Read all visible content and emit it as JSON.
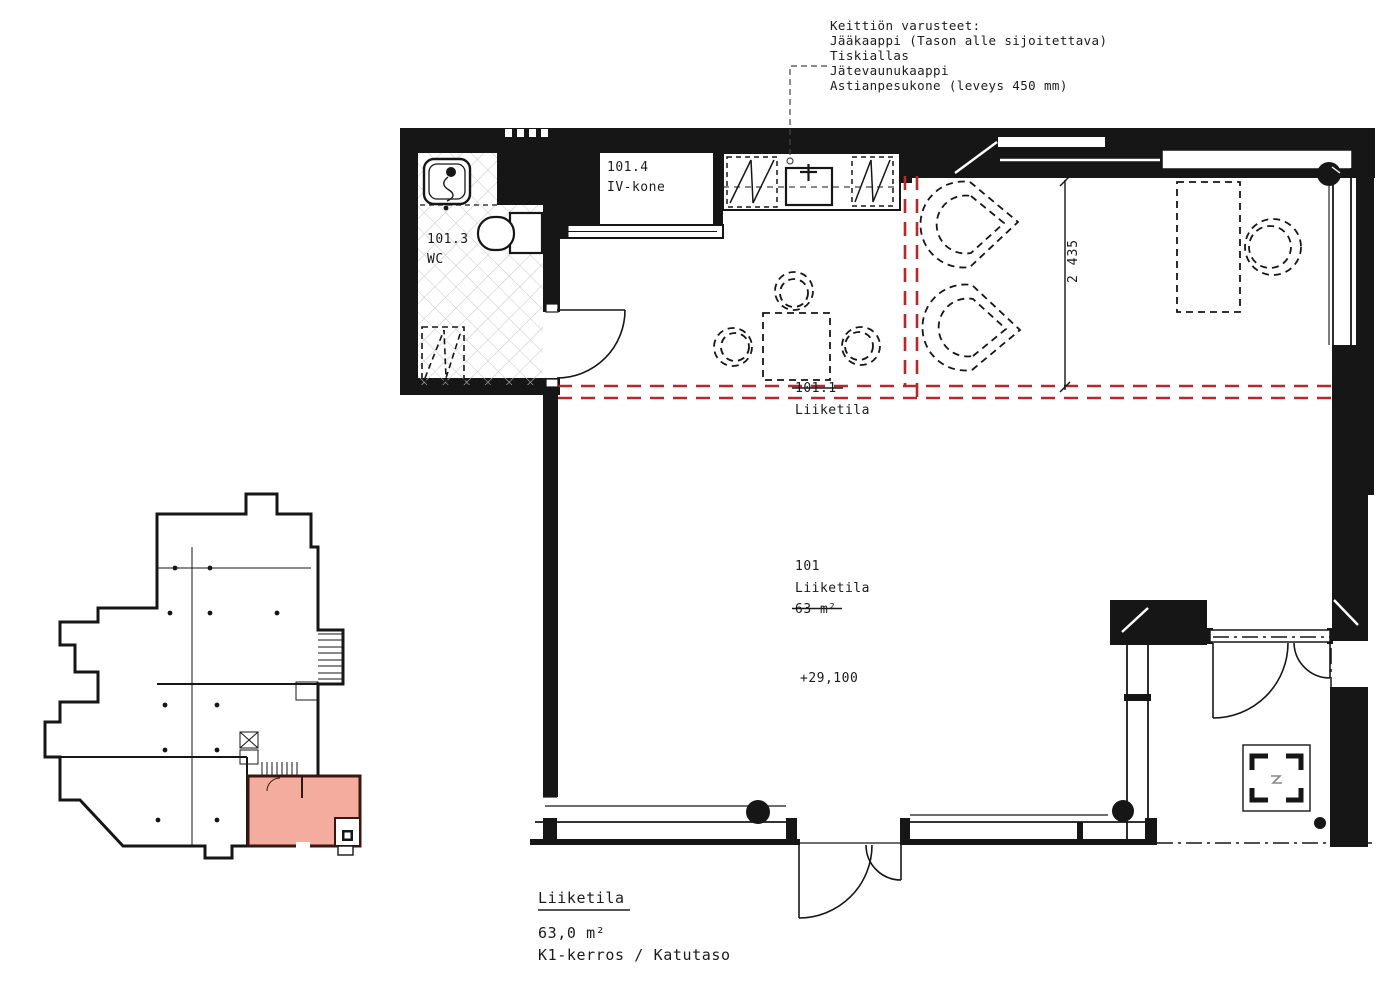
{
  "drawing": {
    "type": "floor-plan",
    "kitchen_note": {
      "lines": [
        "Keittiön varusteet:",
        "Jääkaappi (Tason alle sijoitettava)",
        "Tiskiallas",
        "Jätevaunukaappi",
        "Astianpesukone (leveys 450 mm)"
      ]
    },
    "rooms": {
      "iv_kone": {
        "number": "101.4",
        "name": "IV-kone"
      },
      "wc": {
        "number": "101.3",
        "name": "WC"
      },
      "liiketila_sub": {
        "number": "101.1",
        "name": "Liiketila",
        "number_strikethrough": true
      },
      "liiketila_main": {
        "number": "101",
        "name": "Liiketila",
        "area": "63 m²",
        "area_strikethrough": true,
        "level": "+29,100"
      }
    },
    "dimension": {
      "value": "2 435"
    },
    "footer": {
      "title": "Liiketila",
      "area": "63,0 m²",
      "floor": "K1-kerros / Katutaso"
    },
    "colors": {
      "line": "#161616",
      "red_boundary": "#b5282c",
      "unit_highlight_fill": "#f4ac9e",
      "unit_highlight_stroke": "#381710",
      "tile_grid": "#c9c9c9"
    },
    "key_plan": {
      "meaning": "location key plan, highlighted unit bottom right"
    }
  }
}
